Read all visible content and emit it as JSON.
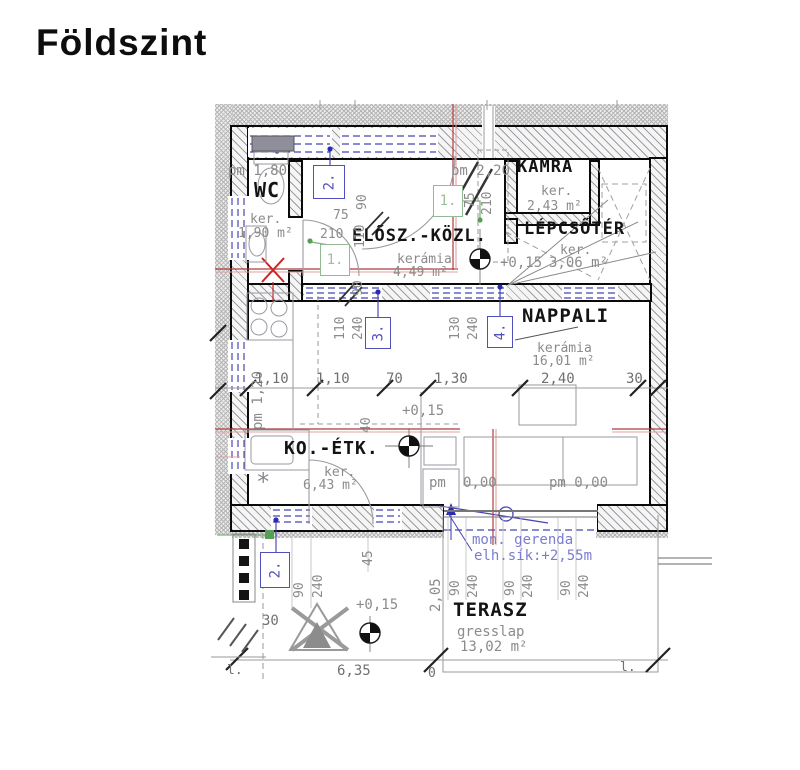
{
  "title": "Földszint",
  "colors": {
    "tag_blue": "#5050bc",
    "tag_green": "#93bb93",
    "section_red": "#b23b3b",
    "note_blue": "#7b7bd0",
    "wall_black": "#0a0a0a"
  },
  "rooms": {
    "wc": {
      "name": "WC",
      "finish": "ker.",
      "area": "1,90 m²"
    },
    "elosz": {
      "name": "ELŐSZ.-KÖZL.",
      "finish": "kerámia",
      "area": "4,49 m²"
    },
    "kamra": {
      "name": "KAMRA",
      "finish": "ker.",
      "area": "2,43 m²"
    },
    "lepcsoter": {
      "name": "LÉPCSŐTÉR",
      "finish": "ker.",
      "area": "3,06 m²"
    },
    "nappali": {
      "name": "NAPPALI",
      "finish": "kerámia",
      "area": "16,01 m²"
    },
    "koetk": {
      "name": "KO.-ÉTK.",
      "finish": "ker.",
      "area": "6,43 m²"
    },
    "terasz": {
      "name": "TERASZ",
      "finish": "gresslap",
      "area": "13,02 m²"
    }
  },
  "levels": {
    "stair": "+0,15",
    "kitchen": "+0,15",
    "terrace": "+0,15"
  },
  "parapets": {
    "wc": "pm 1,80",
    "kamra": "pm 2,20",
    "kitchen": "pm 1,20",
    "nappali_a_label": "pm",
    "nappali_a_value": "0,00",
    "nappali_b": "pm 0,00"
  },
  "tags": {
    "t2_top": "2.",
    "t1_top": "1.",
    "t1_mid": "1.",
    "t3": "3.",
    "t4": "4.",
    "t2_bottom": "2."
  },
  "dims": {
    "chain": [
      "1,10",
      "1,10",
      "70",
      "1,30",
      "2,40",
      "30"
    ],
    "wc_door": [
      "75",
      "210"
    ],
    "kamra_window": [
      "75",
      "210"
    ],
    "entry": [
      "90",
      "110",
      "90"
    ],
    "door3": [
      "110",
      "240"
    ],
    "door4": [
      "130",
      "240"
    ],
    "door2_bottom": [
      "90",
      "240"
    ],
    "terasz_openings": [
      "90",
      "240",
      "90",
      "240",
      "90",
      "240"
    ],
    "misc": {
      "d40": "40",
      "d45": "45",
      "d30": "30",
      "d205": "2,05",
      "d635": "6,35",
      "d0": "0"
    }
  },
  "notes": {
    "beam": "mon. gerenda",
    "beam_level": "elh.sík:+2,55m"
  },
  "marks": {
    "left": "l.",
    "right": "l.",
    "asterisk": "*"
  }
}
